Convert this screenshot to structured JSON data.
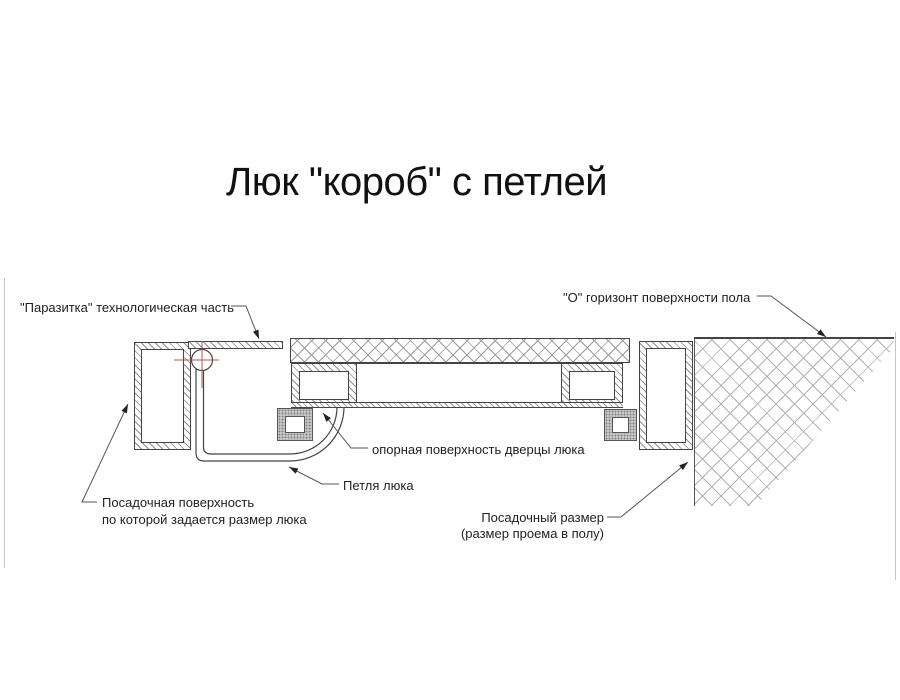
{
  "title": "Люк \"короб\" с петлей",
  "labels": {
    "parasitic": "\"Паразитка\" технологическая часть",
    "floor_level": "\"О\" горизонт поверхности пола",
    "bearing_surface": "опорная поверхность дверцы люка",
    "hinge": "Петля люка",
    "seating_surface_line1": "Посадочная поверхность",
    "seating_surface_line2": "по которой задается размер люка",
    "seating_size_line1": "Посадочный размер",
    "seating_size_line2": "(размер проема в полу)"
  },
  "colors": {
    "drawing_line": "#444444",
    "leader_line": "#555555",
    "hatch_gray": "#9a9a9a",
    "floor_hatch_gray": "#b2b2b2",
    "center_mark_red": "#b4574b",
    "seal_gray": "#c8c8c8",
    "background": "#ffffff"
  }
}
